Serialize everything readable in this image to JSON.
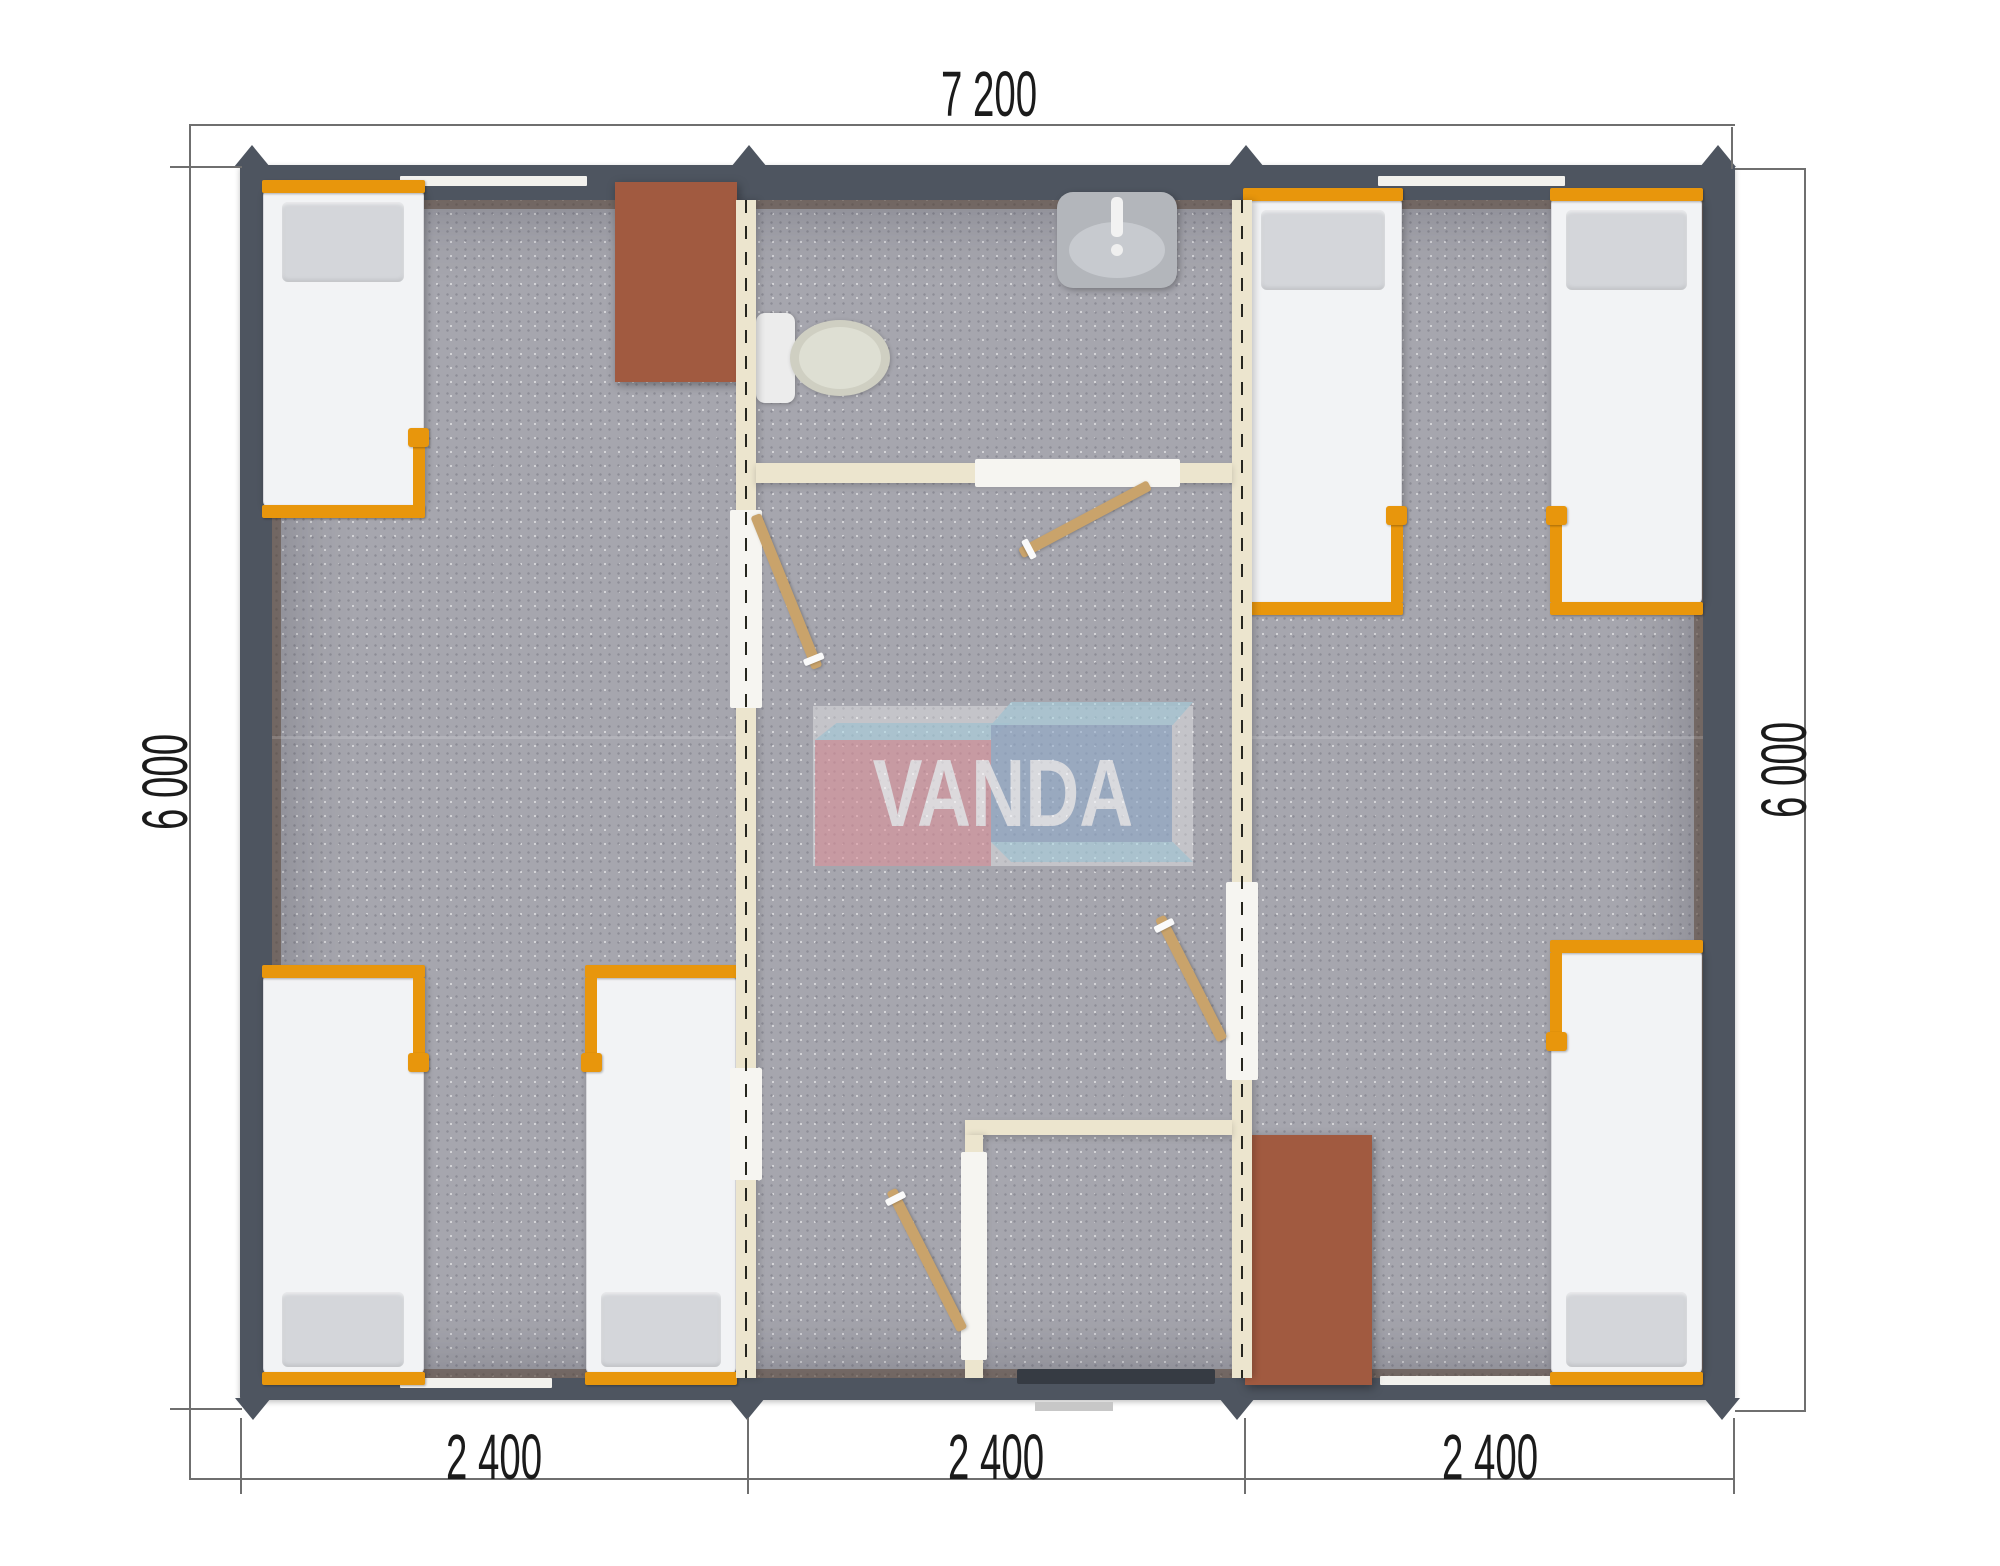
{
  "dimensions": {
    "top": "7 200",
    "left": "6 000",
    "right": "6 000",
    "bottom": [
      "2 400",
      "2 400",
      "2 400"
    ]
  },
  "watermark": {
    "text": "VANDA"
  },
  "colors": {
    "wall": "#4e5560",
    "interior_wall": "#ece5ce",
    "floor": "#a6a6ae",
    "floor_dot": "#8d8d96",
    "bed": "#f2f3f5",
    "pillow": "#d4d6da",
    "frame_orange": "#e8960c",
    "furniture_brown": "#a15a40",
    "door_wood": "#c9a36b",
    "dim_line": "#6f6f6f",
    "text": "#1b1b1b",
    "logo_pink": "#dd8790",
    "logo_blue": "#8ba6c9",
    "logo_sky": "#a5d3e3",
    "window": "#f2f1ed"
  }
}
